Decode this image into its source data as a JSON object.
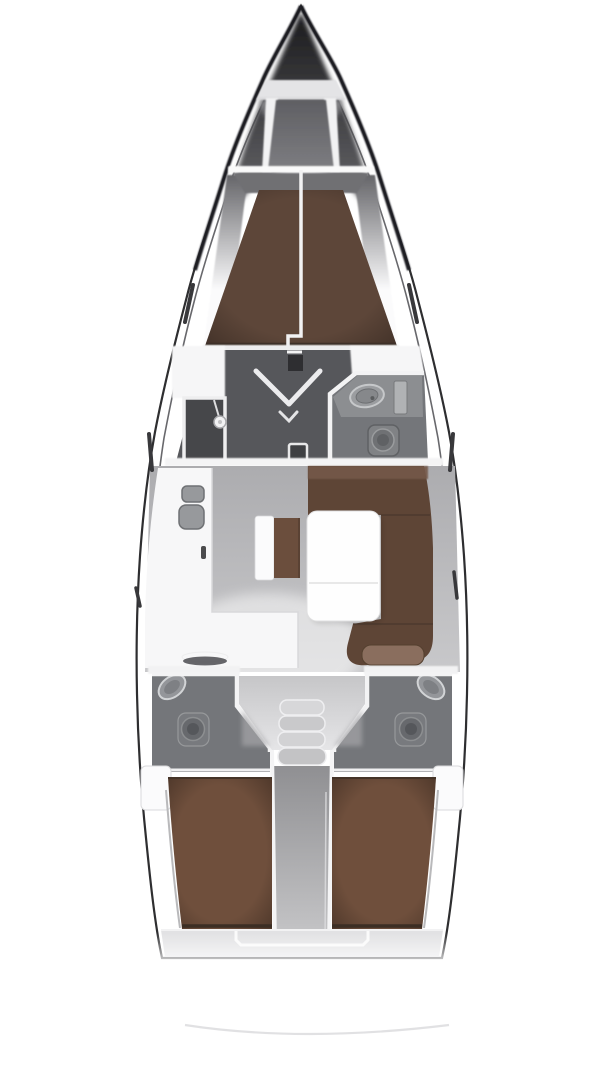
{
  "diagram": {
    "type": "yacht-interior-floor-plan",
    "view": "top-down-bow-up",
    "rooms": [
      {
        "id": "anchor-locker"
      },
      {
        "id": "forward-v-berth-cabin"
      },
      {
        "id": "forward-shower"
      },
      {
        "id": "forward-head"
      },
      {
        "id": "salon"
      },
      {
        "id": "galley"
      },
      {
        "id": "aft-head-port"
      },
      {
        "id": "aft-head-starboard"
      },
      {
        "id": "companionway"
      },
      {
        "id": "aft-cabin-port"
      },
      {
        "id": "aft-cabin-starboard"
      }
    ],
    "fixtures": [
      {
        "id": "mast-base"
      },
      {
        "id": "double-sink"
      },
      {
        "id": "stove"
      },
      {
        "id": "shower-head"
      },
      {
        "id": "wash-basin"
      },
      {
        "id": "toilet"
      },
      {
        "id": "salon-table"
      },
      {
        "id": "u-settee"
      },
      {
        "id": "companionway-steps"
      },
      {
        "id": "engine-compartment"
      },
      {
        "id": "swim-platform-arc"
      }
    ],
    "palette": {
      "background": "#ffffff",
      "hull_line": "#2e2e30",
      "v_berth_brown": "#5d4639",
      "settee_brown": "#5e4536",
      "settee_back_brown": "#75594a",
      "bench_brown": "#6b4e3d",
      "bench_white": "#fbfbfc",
      "pillow_brown": "#8a6e5e",
      "aft_berth_brown": "#6f4f3c",
      "salon_floor_gray": "#a9a9ac",
      "forward_floor_dark": "#56575b",
      "shower_dark": "#46474a",
      "head_floor_gray": "#74767a",
      "fixture_gray": "#7d7f83",
      "counter_white": "#f7f7f8",
      "table_white": "#fefefe",
      "step_gray": "#cdcdcf",
      "stern_band_gray": "#e2e2e4",
      "window_slit_dark": "#38383b"
    }
  }
}
